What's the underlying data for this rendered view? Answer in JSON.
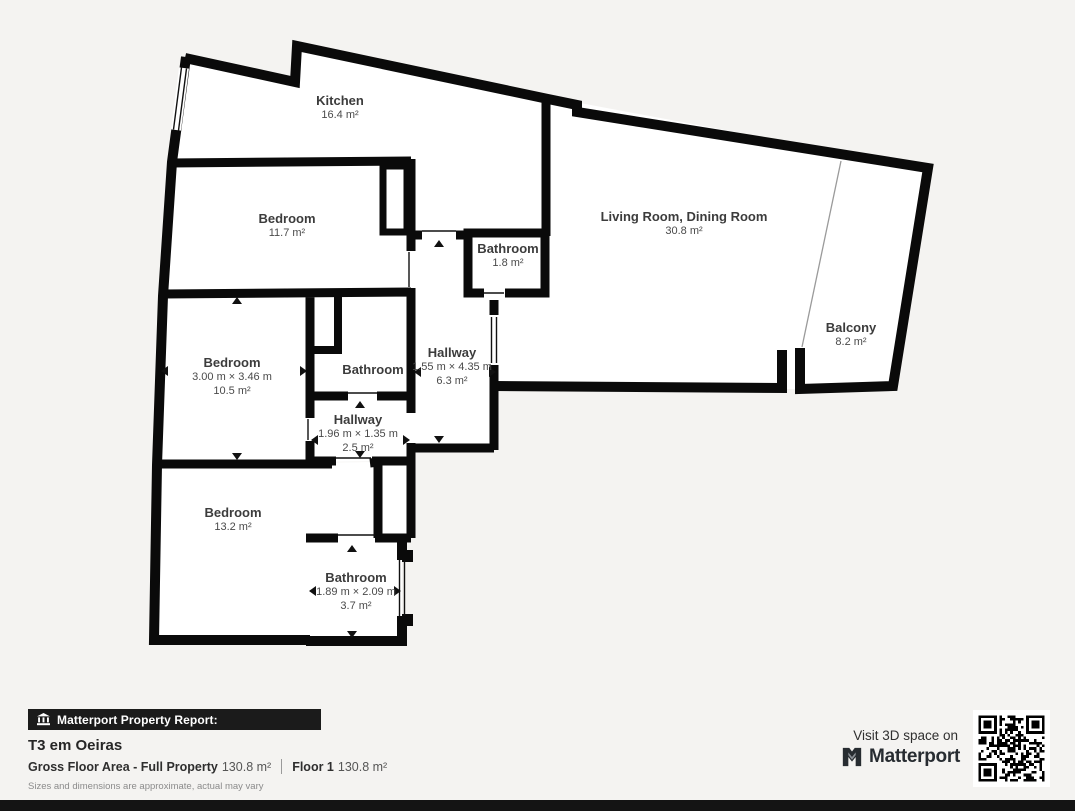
{
  "colors": {
    "background": "#f4f3f1",
    "wall": "#0a0a0a",
    "footer_bar": "#1b1b1b"
  },
  "rooms": [
    {
      "id": "kitchen",
      "name": "Kitchen",
      "area": "16.4 m²"
    },
    {
      "id": "bedroom-top",
      "name": "Bedroom",
      "area": "11.7 m²"
    },
    {
      "id": "bathroom-small",
      "name": "Bathroom",
      "area": "1.8 m²"
    },
    {
      "id": "living-dining",
      "name": "Living Room, Dining Room",
      "area": "30.8 m²"
    },
    {
      "id": "balcony",
      "name": "Balcony",
      "area": "8.2 m²"
    },
    {
      "id": "bedroom-middle",
      "name": "Bedroom",
      "dimensions": "3.00 m × 3.46 m",
      "area": "10.5 m²"
    },
    {
      "id": "bathroom-middle",
      "name": "Bathroom"
    },
    {
      "id": "hallway-long",
      "name": "Hallway",
      "dimensions": "1.55 m × 4.35 m",
      "area": "6.3 m²"
    },
    {
      "id": "hallway-small",
      "name": "Hallway",
      "dimensions": "1.96 m × 1.35 m",
      "area": "2.5 m²"
    },
    {
      "id": "bedroom-bottom",
      "name": "Bedroom",
      "area": "13.2 m²"
    },
    {
      "id": "bathroom-bottom",
      "name": "Bathroom",
      "dimensions": "1.89 m × 2.09 m",
      "area": "3.7 m²"
    }
  ],
  "report": {
    "banner": "Matterport Property Report:",
    "property_title": "T3 em Oeiras",
    "gross_floor_label": "Gross Floor Area - Full Property",
    "gross_floor_value": "130.8 m²",
    "floor_label": "Floor 1",
    "floor_value": "130.8 m²",
    "disclaimer": "Sizes and dimensions are approximate, actual may vary"
  },
  "promo": {
    "visit_text": "Visit 3D space on",
    "brand": "Matterport"
  }
}
